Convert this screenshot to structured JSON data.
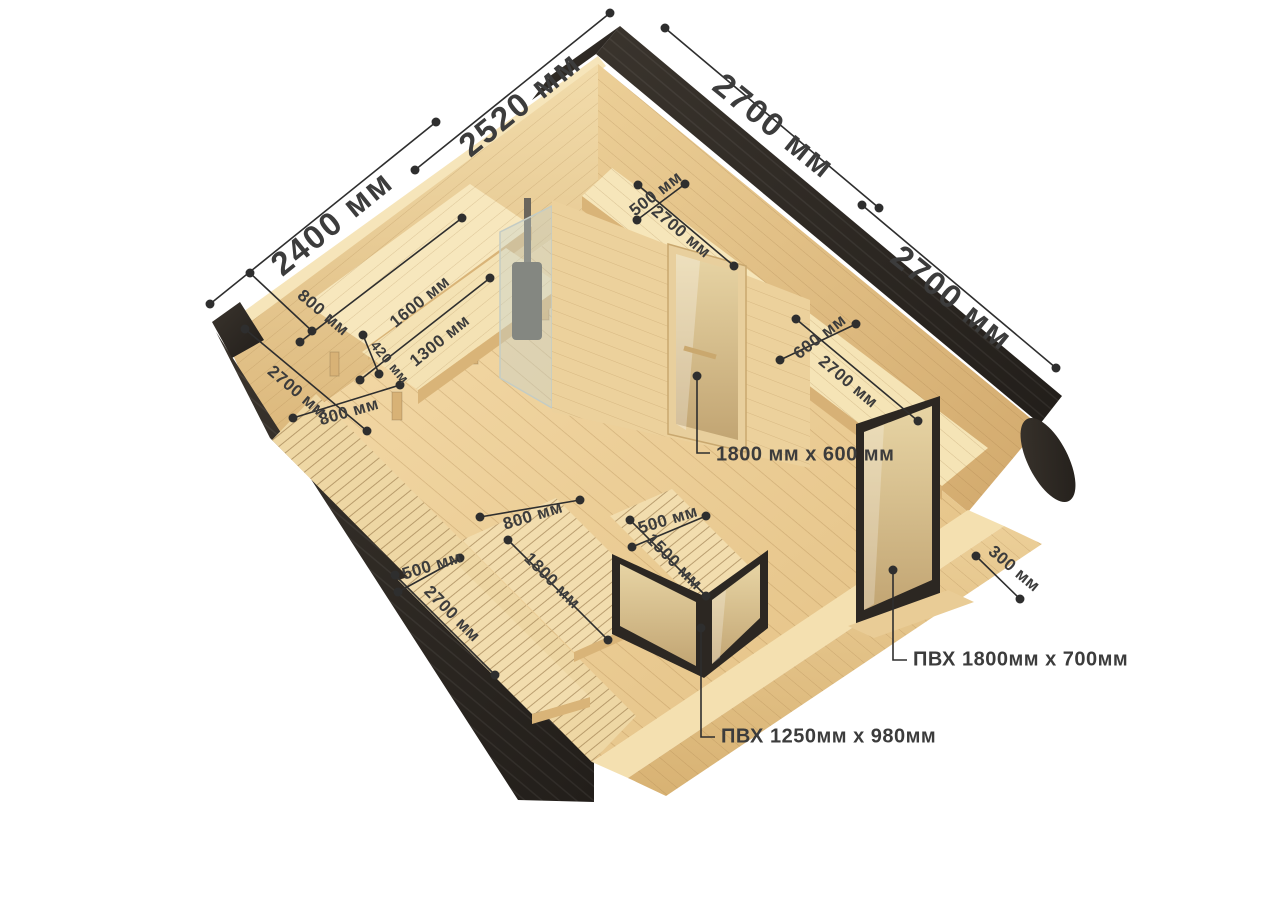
{
  "diagram": {
    "type": "isometric cutaway dimension diagram of a wooden quadro sauna cabin",
    "units": "мм"
  },
  "dims": {
    "building_width_front": "2400 мм",
    "building_depth_left": "2520 мм",
    "building_width_back": "2700 мм",
    "building_depth_right": "2700 мм",
    "shelf_top_width": "500 мм",
    "shelf_top_length": "2700 мм",
    "sauna_bench_width": "800 мм",
    "sauna_bench_top_length": "1600 мм",
    "sauna_bench_low_length": "1300 мм",
    "sauna_bench_step": "420 мм",
    "sauna_lounger_length": "2700 мм",
    "sauna_lounger_width": "800 мм",
    "right_shelf_width": "600 мм",
    "right_shelf_length": "2700 мм",
    "center_lounger_width": "800 мм",
    "center_lounger_length": "1800 мм",
    "right_lounger_width": "500 мм",
    "right_lounger_length": "1500 мм",
    "left_lounger_width": "500 мм",
    "left_lounger_length": "2700 мм",
    "ledge_width": "300 мм"
  },
  "callouts": {
    "glass_door": "1800 мм x 600 мм",
    "pvc_window_right": "ПВХ 1800мм x 700мм",
    "pvc_window_front": "ПВХ 1250мм x 980мм"
  },
  "colors": {
    "wood_light": "#f0d6a2",
    "wood_mid": "#ddb87c",
    "roof_dark": "#332e28",
    "label_text": "#3c3c3c"
  }
}
